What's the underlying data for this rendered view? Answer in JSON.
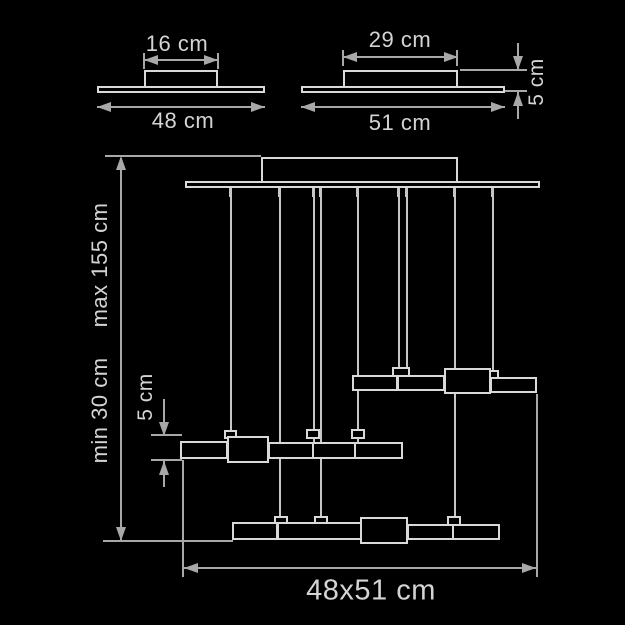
{
  "diagram_type": "pendant lamp technical dimension drawing",
  "colors": {
    "background": "#000000",
    "structure_lines": "#d9d9d9",
    "dimension_lines": "#a8a8a8",
    "text": "#d4d4d4"
  },
  "views": {
    "canopy_small": {
      "description": "small ceiling canopy side view",
      "top_width_label": "16 cm",
      "base_width_label": "48 cm"
    },
    "canopy_large": {
      "description": "large ceiling canopy side view",
      "top_width_label": "29 cm",
      "base_width_label": "51 cm",
      "height_label": "5 cm"
    },
    "pendant": {
      "description": "suspended light bars front view",
      "height_min_label": "min 30 cm",
      "height_max_label": "max 155 cm",
      "bar_height_label": "5 cm",
      "footprint_label": "48x51 cm"
    }
  }
}
